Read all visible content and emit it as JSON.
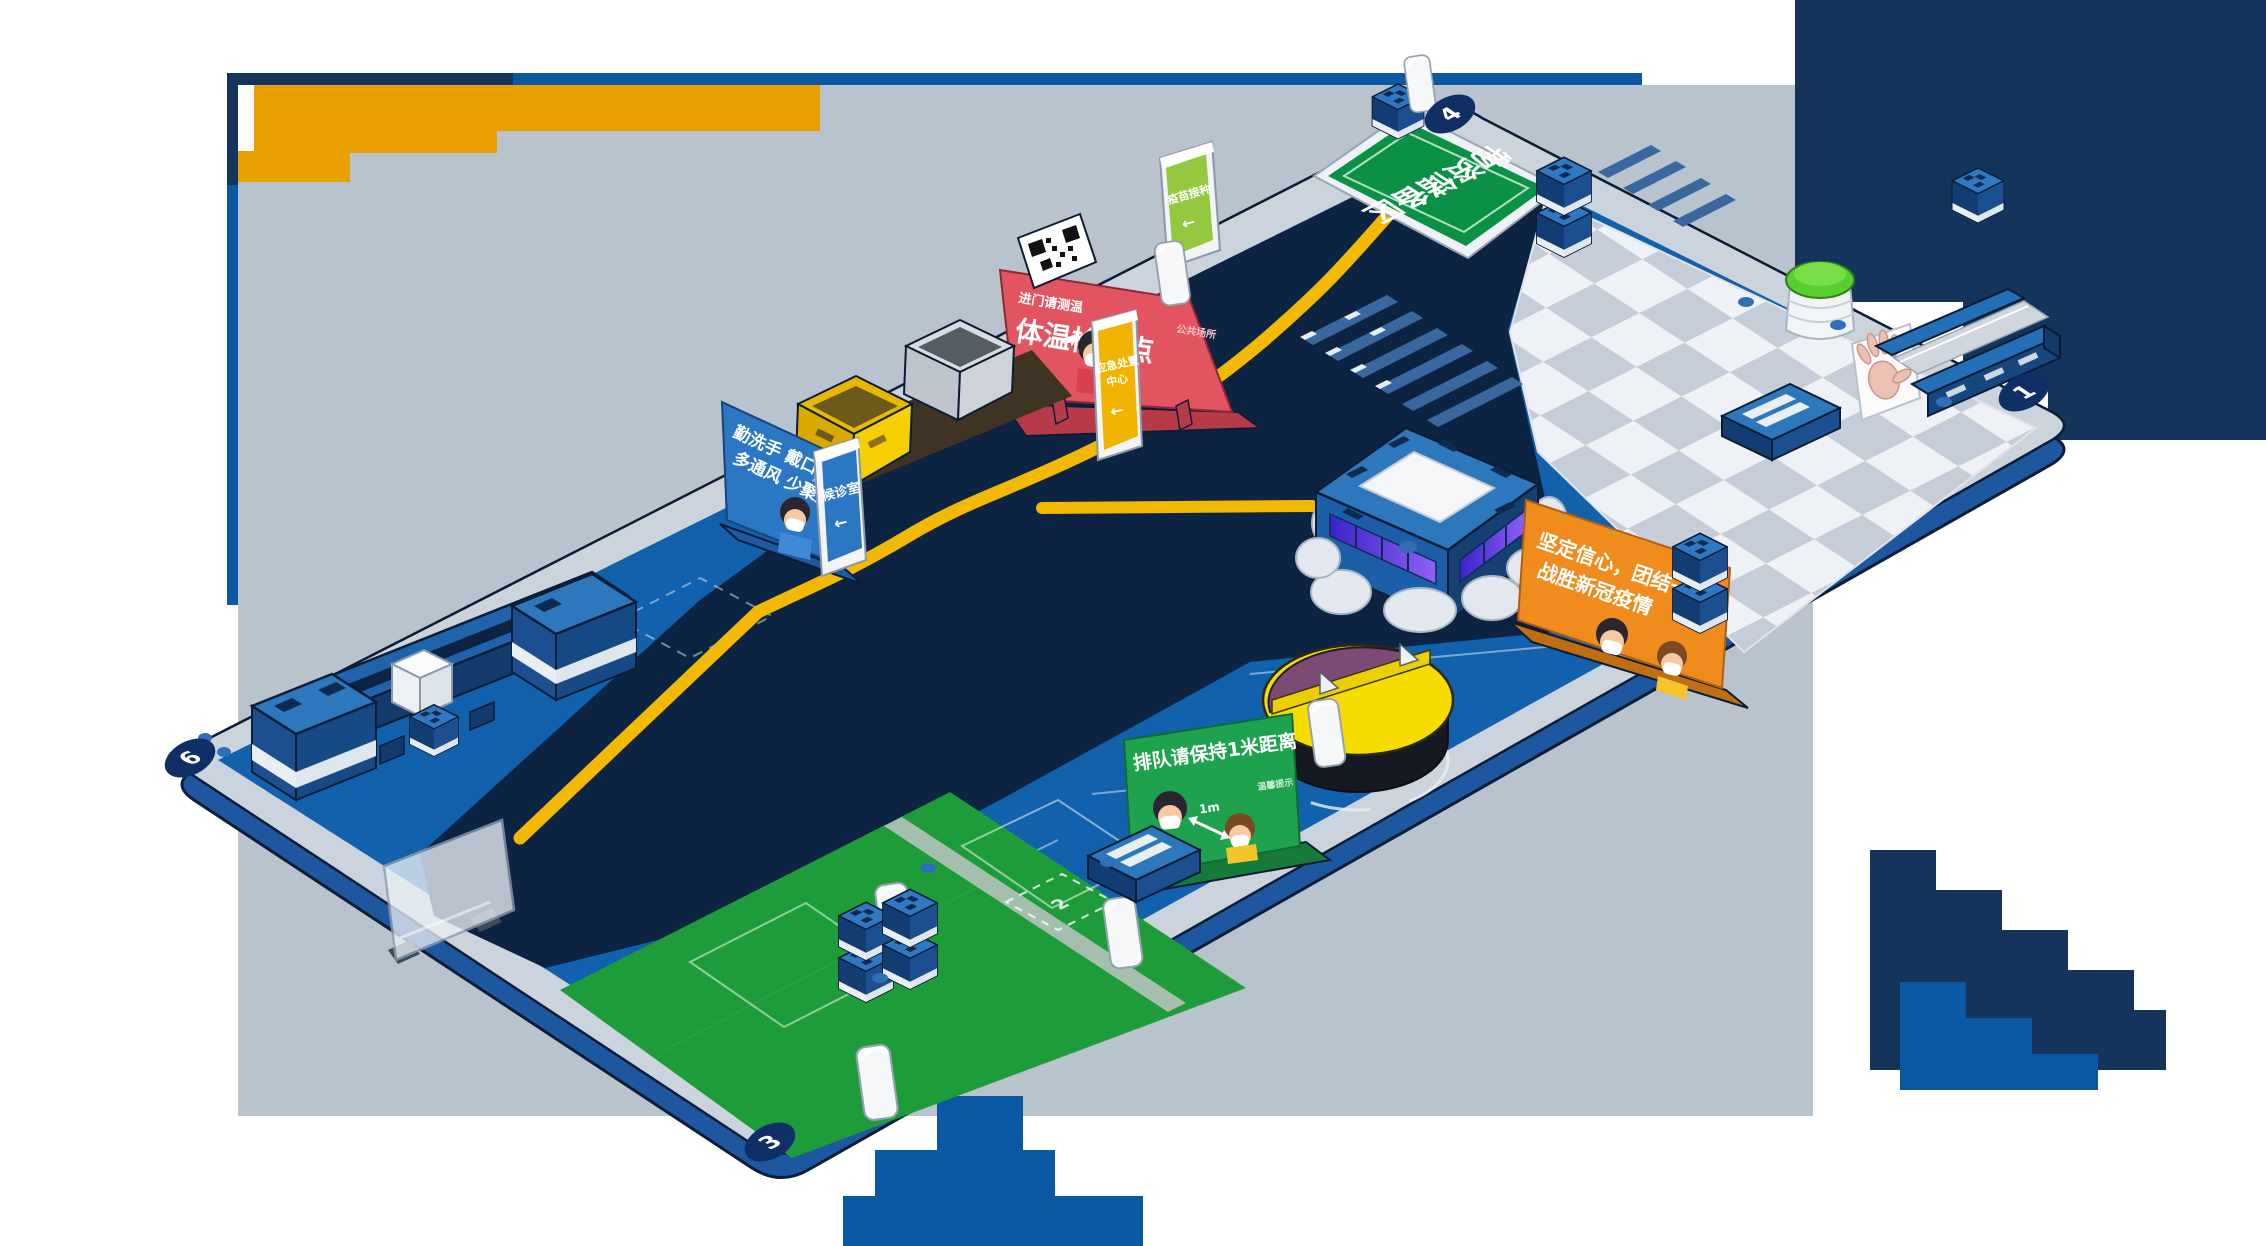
{
  "signs": {
    "temp_main": "体温检测点",
    "temp_sub": "进门请测温",
    "temp_side": "公共场所",
    "hygiene1": "勤洗手 戴口罩",
    "hygiene2": "多通风 少聚集",
    "note": "温馨提示",
    "unity1": "坚定信心，团结一致",
    "unity2": "战胜新冠疫情",
    "queue": "排队请保持1米距离",
    "distance": "1m",
    "emergency1": "应急处置",
    "emergency2": "中心",
    "arrow": "←",
    "waiting": "候诊室",
    "vaccine": "疫苗接种",
    "supply": "物资储备区"
  },
  "markers": {
    "top": "4",
    "right": "1",
    "bottom": "3",
    "left": "6",
    "plot": "2"
  },
  "colors": {
    "field_blue": "#1161ad",
    "road_navy": "#0d2342",
    "rim_gray": "#cbd3dc",
    "line_yellow": "#f3b800",
    "grass_green": "#1f9c3a",
    "backdrop_gray": "#b9c3cd",
    "deco_navy": "#14345c",
    "deco_blue": "#0a57a2",
    "deco_orange": "#e8a000",
    "sign_red": "#e2545f",
    "sign_blue": "#2b77c4",
    "sign_orange": "#f08c1e",
    "sign_green": "#1fa24e",
    "pillar_green": "#94c83e",
    "pillar_yellow": "#f0b400",
    "turntable_yellow": "#f7dc00",
    "turntable_purple": "#7d4a74"
  }
}
